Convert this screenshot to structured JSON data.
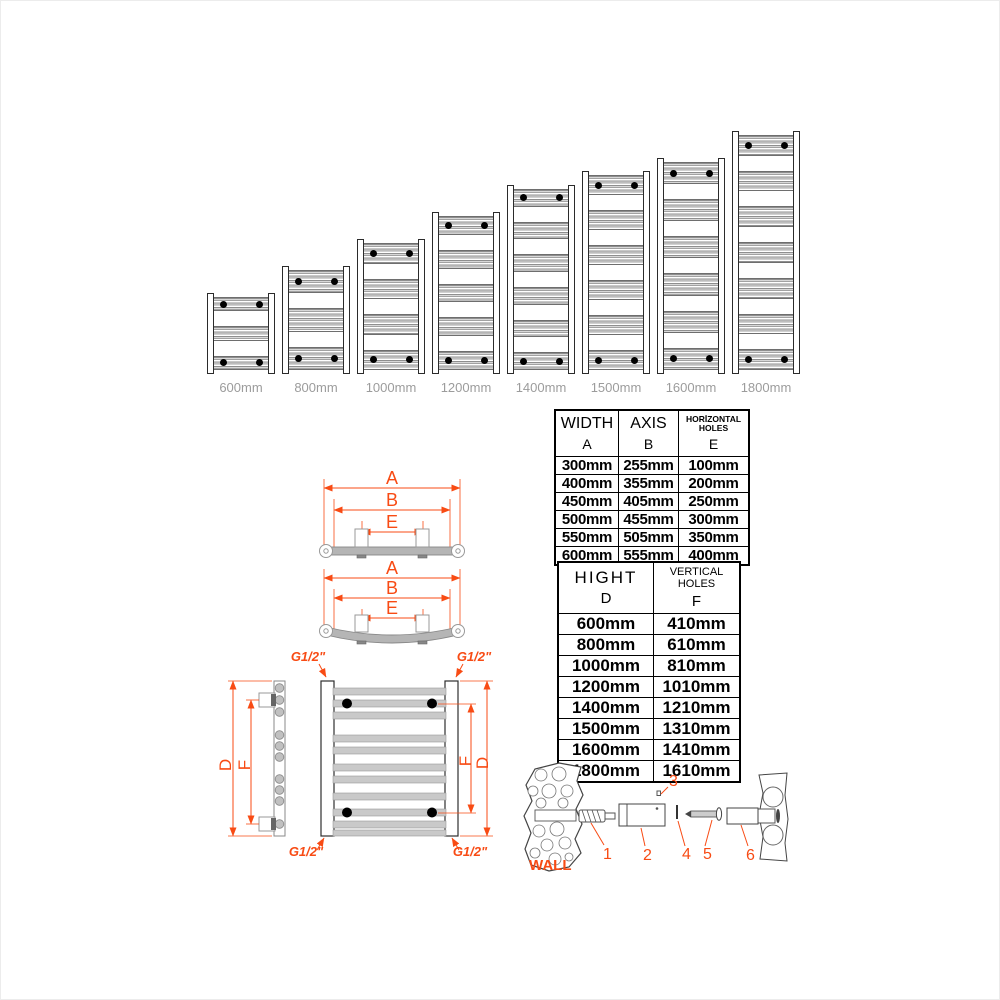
{
  "accent_color": "#F84B14",
  "label_color": "#9c9c9c",
  "radiator_row": {
    "items": [
      {
        "label": "600mm",
        "height_mm": 600
      },
      {
        "label": "800mm",
        "height_mm": 800
      },
      {
        "label": "1000mm",
        "height_mm": 1000
      },
      {
        "label": "1200mm",
        "height_mm": 1200
      },
      {
        "label": "1400mm",
        "height_mm": 1400
      },
      {
        "label": "1500mm",
        "height_mm": 1500
      },
      {
        "label": "1600mm",
        "height_mm": 1600
      },
      {
        "label": "1800mm",
        "height_mm": 1800
      }
    ]
  },
  "width_table": {
    "columns": [
      {
        "title": "WIDTH",
        "letter": "A"
      },
      {
        "title": "AXIS",
        "letter": "B"
      },
      {
        "title": "HORİZONTAL HOLES",
        "letter": "E"
      }
    ],
    "rows": [
      [
        "300mm",
        "255mm",
        "100mm"
      ],
      [
        "400mm",
        "355mm",
        "200mm"
      ],
      [
        "450mm",
        "405mm",
        "250mm"
      ],
      [
        "500mm",
        "455mm",
        "300mm"
      ],
      [
        "550mm",
        "505mm",
        "350mm"
      ],
      [
        "600mm",
        "555mm",
        "400mm"
      ]
    ]
  },
  "height_table": {
    "columns": [
      {
        "title": "HIGHT",
        "letter": "D"
      },
      {
        "title": "VERTICAL HOLES",
        "letter": "F"
      }
    ],
    "rows": [
      [
        "600mm",
        "410mm"
      ],
      [
        "800mm",
        "610mm"
      ],
      [
        "1000mm",
        "810mm"
      ],
      [
        "1200mm",
        "1010mm"
      ],
      [
        "1400mm",
        "1210mm"
      ],
      [
        "1500mm",
        "1310mm"
      ],
      [
        "1600mm",
        "1410mm"
      ],
      [
        "1800mm",
        "1610mm"
      ]
    ]
  },
  "dimensions": {
    "width_letter": "A",
    "axis_letter": "B",
    "horizontal_holes_letter": "E",
    "height_letter": "D",
    "vertical_holes_letter": "F",
    "thread_label": "G1/2\""
  },
  "hardware": {
    "wall_label": "WALL",
    "parts": [
      "1",
      "2",
      "3",
      "4",
      "5",
      "6"
    ]
  }
}
